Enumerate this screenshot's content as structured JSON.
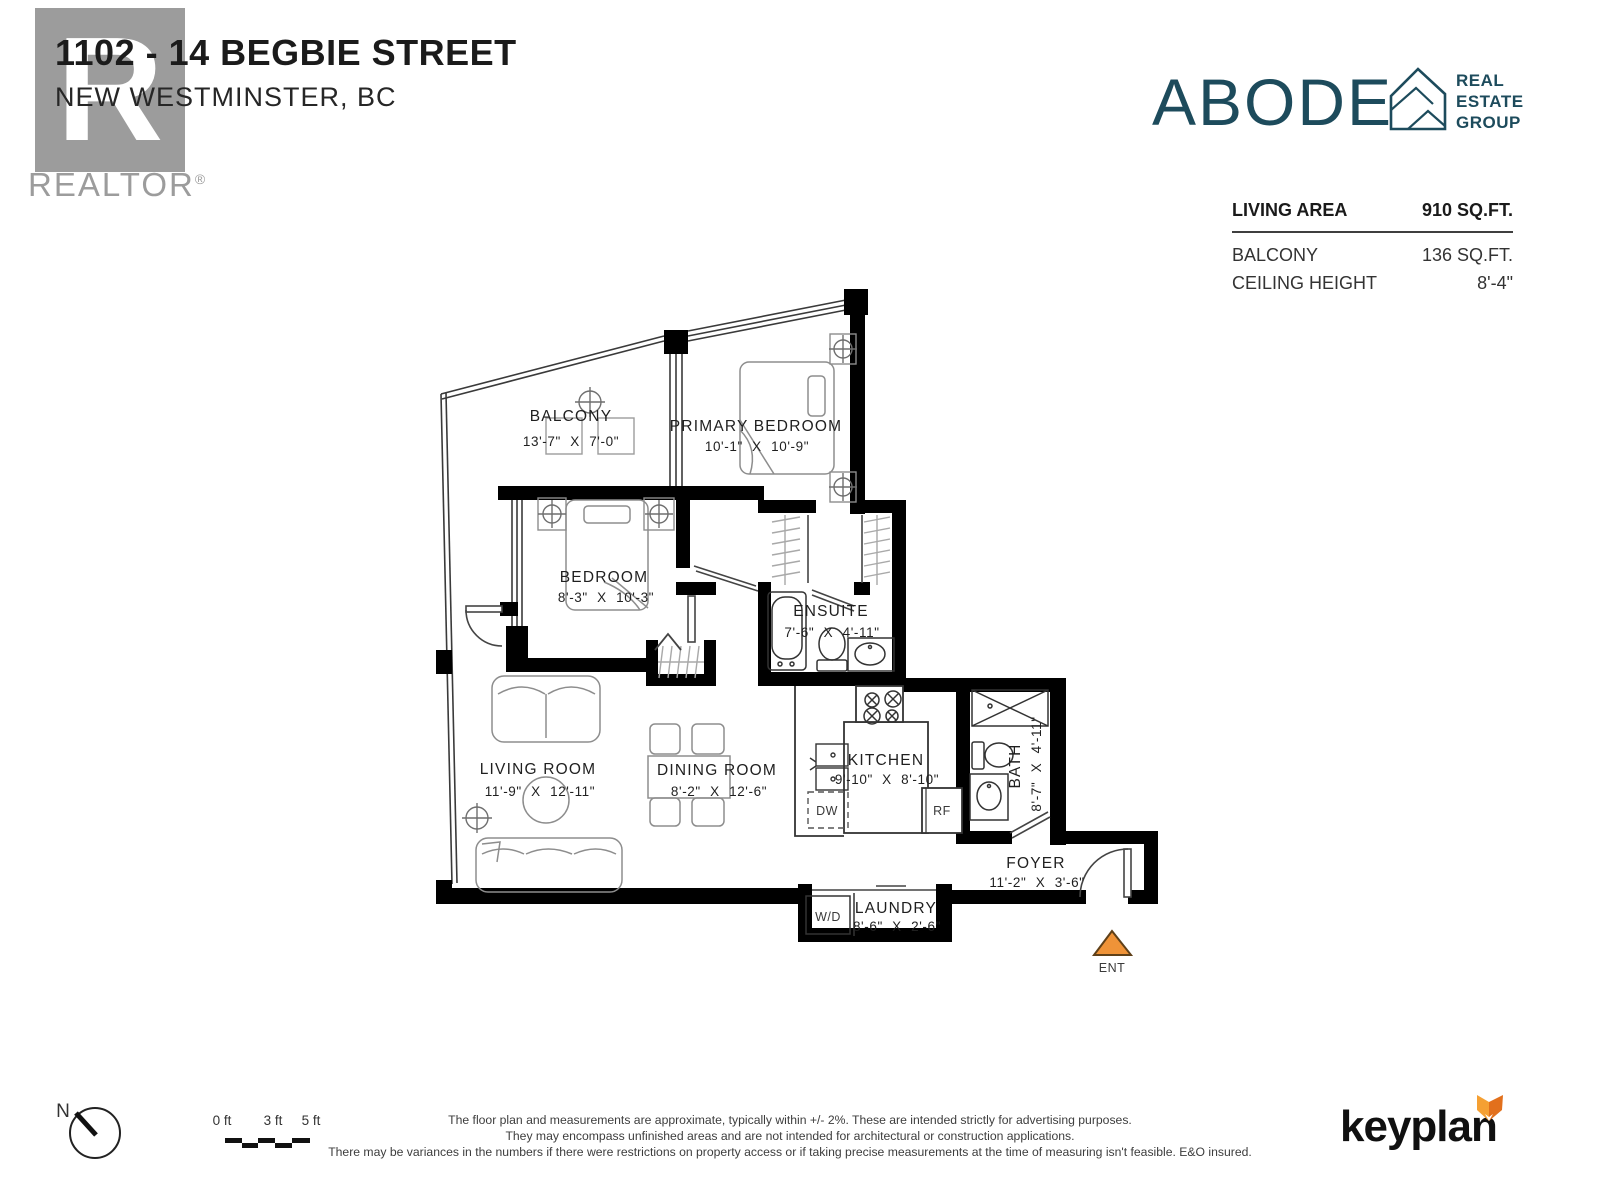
{
  "header": {
    "address_line1": "1102 - 14 BEGBIE STREET",
    "address_line2": "NEW WESTMINSTER, BC",
    "realtor_logo_letter": "R",
    "realtor_wordmark": "REALTOR",
    "realtor_mark": "®"
  },
  "brand": {
    "name": "ABODE",
    "tagline_lines": [
      "REAL",
      "ESTATE",
      "GROUP"
    ],
    "color": "#1d4b5c"
  },
  "stats": {
    "rows": [
      {
        "label": "LIVING AREA",
        "value": "910 SQ.FT."
      },
      {
        "label": "BALCONY",
        "value": "136 SQ.FT."
      },
      {
        "label": "CEILING HEIGHT",
        "value": "8'-4\""
      }
    ]
  },
  "floor_plan": {
    "rooms": [
      {
        "name": "BALCONY",
        "dims": "13'-7\" X 7'-0\""
      },
      {
        "name": "PRIMARY BEDROOM",
        "dims": "10'-1\" X 10'-9\""
      },
      {
        "name": "BEDROOM",
        "dims": "8'-3\" X 10'-3\""
      },
      {
        "name": "ENSUITE",
        "dims": "7'-6\" X 4'-11\""
      },
      {
        "name": "LIVING ROOM",
        "dims": "11'-9\" X 12'-11\""
      },
      {
        "name": "DINING ROOM",
        "dims": "8'-2\" X 12'-6\""
      },
      {
        "name": "KITCHEN",
        "dims": "9'-10\" X 8'-10\""
      },
      {
        "name": "BATH",
        "dims": "8'-7\" X 4'-11\""
      },
      {
        "name": "FOYER",
        "dims": "11'-2\" X 3'-6\""
      },
      {
        "name": "LAUNDRY",
        "dims": "8'-6\" X 2'-6\""
      }
    ],
    "appliances": {
      "dishwasher": "DW",
      "fridge": "RF",
      "washer_dryer": "W/D"
    },
    "entry_label": "ENT",
    "entry_color": "#ef9338"
  },
  "footer": {
    "compass_label": "N",
    "scale_labels": [
      "0 ft",
      "3 ft",
      "5 ft"
    ],
    "disclaimer_lines": [
      "The floor plan and measurements are approximate, typically within +/- 2%. These are intended strictly for advertising purposes.",
      "They may encompass unfinished areas and are not intended for architectural or construction applications.",
      "There may be variances in the numbers if there were restrictions on property access or if taking precise measurements at the time of measuring isn't feasible. E&O insured."
    ],
    "keyplan_logo": "keyplan"
  }
}
